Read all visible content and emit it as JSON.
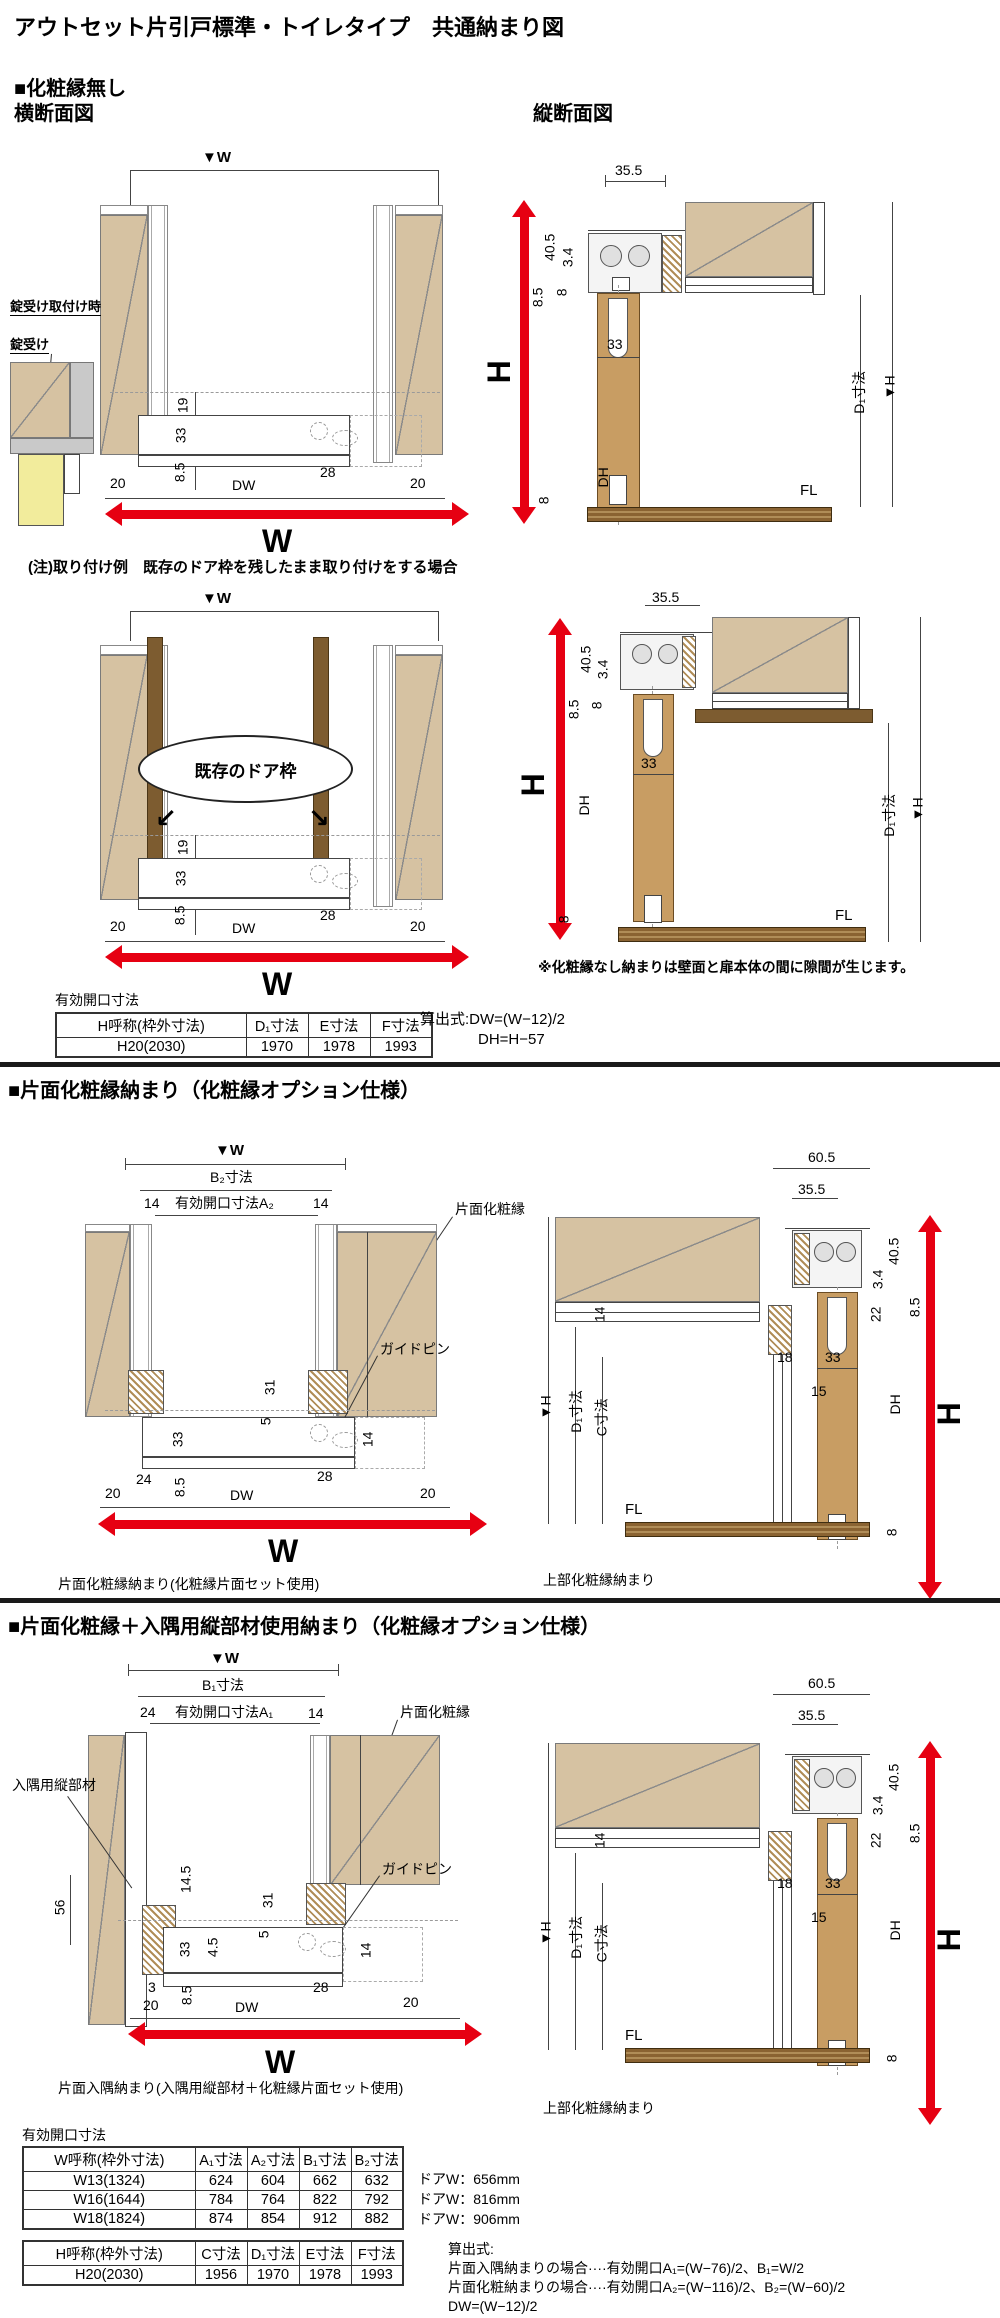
{
  "title": "アウトセット片引戸標準・トイレタイプ　共通納まり図",
  "colors": {
    "red_arrow": "#e60012",
    "wall_tan": "#d6c2a2",
    "door_wood": "#c89d63",
    "frame_brown": "#7d5c30",
    "lock_yellow": "#f2ec9c"
  },
  "s1": {
    "heading": "■化粧縁無し",
    "cross_title": "横断面図",
    "vert_title": "縦断面図",
    "w_marker": "▼W",
    "lock_when": "錠受け取付け時",
    "lock": "錠受け",
    "note": "(注)取り付け例　既存のドア枠を残したまま取り付けをする場合",
    "existing_frame": "既存のドア枠",
    "gap_note": "※化粧縁なし納まりは壁面と扉本体の間に隙間が生じます。",
    "cross": {
      "d19": "19",
      "d33": "33",
      "d85": "8.5",
      "d20l": "20",
      "dw": "DW",
      "d28": "28",
      "d20r": "20",
      "w": "W"
    },
    "vert": {
      "d355": "35.5",
      "d405": "40.5",
      "d34": "3.4",
      "d85": "8.5",
      "d8": "8",
      "d33": "33",
      "dh": "DH",
      "h": "H",
      "hm": "▼H",
      "d1": "D₁寸法",
      "fl": "FL",
      "d8b": "8"
    },
    "table": {
      "title": "有効開口寸法",
      "h0": "H呼称(枠外寸法)",
      "h1": "D₁寸法",
      "h2": "E寸法",
      "h3": "F寸法",
      "r0": "H20(2030)",
      "r1": "1970",
      "r2": "1978",
      "r3": "1993",
      "f1": "算出式:DW=(W−12)/2",
      "f2": "DH=H−57"
    }
  },
  "s2": {
    "heading": "■片面化粧縁納まり（化粧縁オプション仕様）",
    "cross": {
      "wm": "▼W",
      "b": "B₂寸法",
      "n14l": "14",
      "open": "有効開口寸法A₂",
      "n14r": "14",
      "kesho": "片面化粧縁",
      "guide": "ガイドピン",
      "d31": "31",
      "d5": "5",
      "d14": "14",
      "d33": "33",
      "d24": "24",
      "d85": "8.5",
      "d28": "28",
      "d20l": "20",
      "dw": "DW",
      "d20r": "20",
      "w": "W",
      "caption": "片面化粧縁納まり(化粧縁片面セット使用)"
    },
    "vert": {
      "d605": "60.5",
      "d355": "35.5",
      "d405": "40.5",
      "d34": "3.4",
      "d22": "22",
      "d85": "8.5",
      "d14": "14",
      "d18": "18",
      "d33": "33",
      "d15": "15",
      "dh": "DH",
      "h": "H",
      "hm": "▼H",
      "d1": "D₁寸法",
      "c": "C寸法",
      "fl": "FL",
      "d8": "8",
      "caption": "上部化粧縁納まり"
    }
  },
  "s3": {
    "heading": "■片面化粧縁＋入隅用縦部材使用納まり（化粧縁オプション仕様）",
    "cross": {
      "wm": "▼W",
      "b": "B₁寸法",
      "n24": "24",
      "open": "有効開口寸法A₁",
      "n14": "14",
      "kesho": "片面化粧縁",
      "corner": "入隅用縦部材",
      "guide": "ガイドピン",
      "d56": "56",
      "d145": "14.5",
      "d31": "31",
      "d5": "5",
      "d33": "33",
      "d45": "4.5",
      "d14": "14",
      "d3": "3",
      "d20l": "20",
      "d85": "8.5",
      "d28": "28",
      "dw": "DW",
      "d20r": "20",
      "w": "W",
      "caption": "片面入隅納まり(入隅用縦部材＋化粧縁片面セット使用)"
    },
    "vert": {
      "d605": "60.5",
      "d355": "35.5",
      "d405": "40.5",
      "d34": "3.4",
      "d22": "22",
      "d85": "8.5",
      "d14": "14",
      "d18": "18",
      "d33": "33",
      "d15": "15",
      "dh": "DH",
      "h": "H",
      "hm": "▼H",
      "d1": "D₁寸法",
      "c": "C寸法",
      "fl": "FL",
      "d8": "8",
      "caption": "上部化粧縁納まり"
    }
  },
  "tables": {
    "title": "有効開口寸法",
    "w": {
      "h": [
        "W呼称(枠外寸法)",
        "A₁寸法",
        "A₂寸法",
        "B₁寸法",
        "B₂寸法"
      ],
      "rows": [
        [
          "W13(1324)",
          "624",
          "604",
          "662",
          "632"
        ],
        [
          "W16(1644)",
          "784",
          "764",
          "822",
          "792"
        ],
        [
          "W18(1824)",
          "874",
          "854",
          "912",
          "882"
        ]
      ],
      "notes": [
        "ドアW：656mm",
        "ドアW：816mm",
        "ドアW：906mm"
      ]
    },
    "hh": {
      "h": [
        "H呼称(枠外寸法)",
        "C寸法",
        "D₁寸法",
        "E寸法",
        "F寸法"
      ],
      "rows": [
        [
          "H20(2030)",
          "1956",
          "1970",
          "1978",
          "1993"
        ]
      ]
    },
    "formulas": [
      "算出式:",
      "片面入隅納まりの場合····有効開口A₁=(W−76)/2、B₁=W/2",
      "片面化粧納まりの場合····有効開口A₂=(W−116)/2、B₂=(W−60)/2",
      "DW=(W−12)/2"
    ]
  }
}
